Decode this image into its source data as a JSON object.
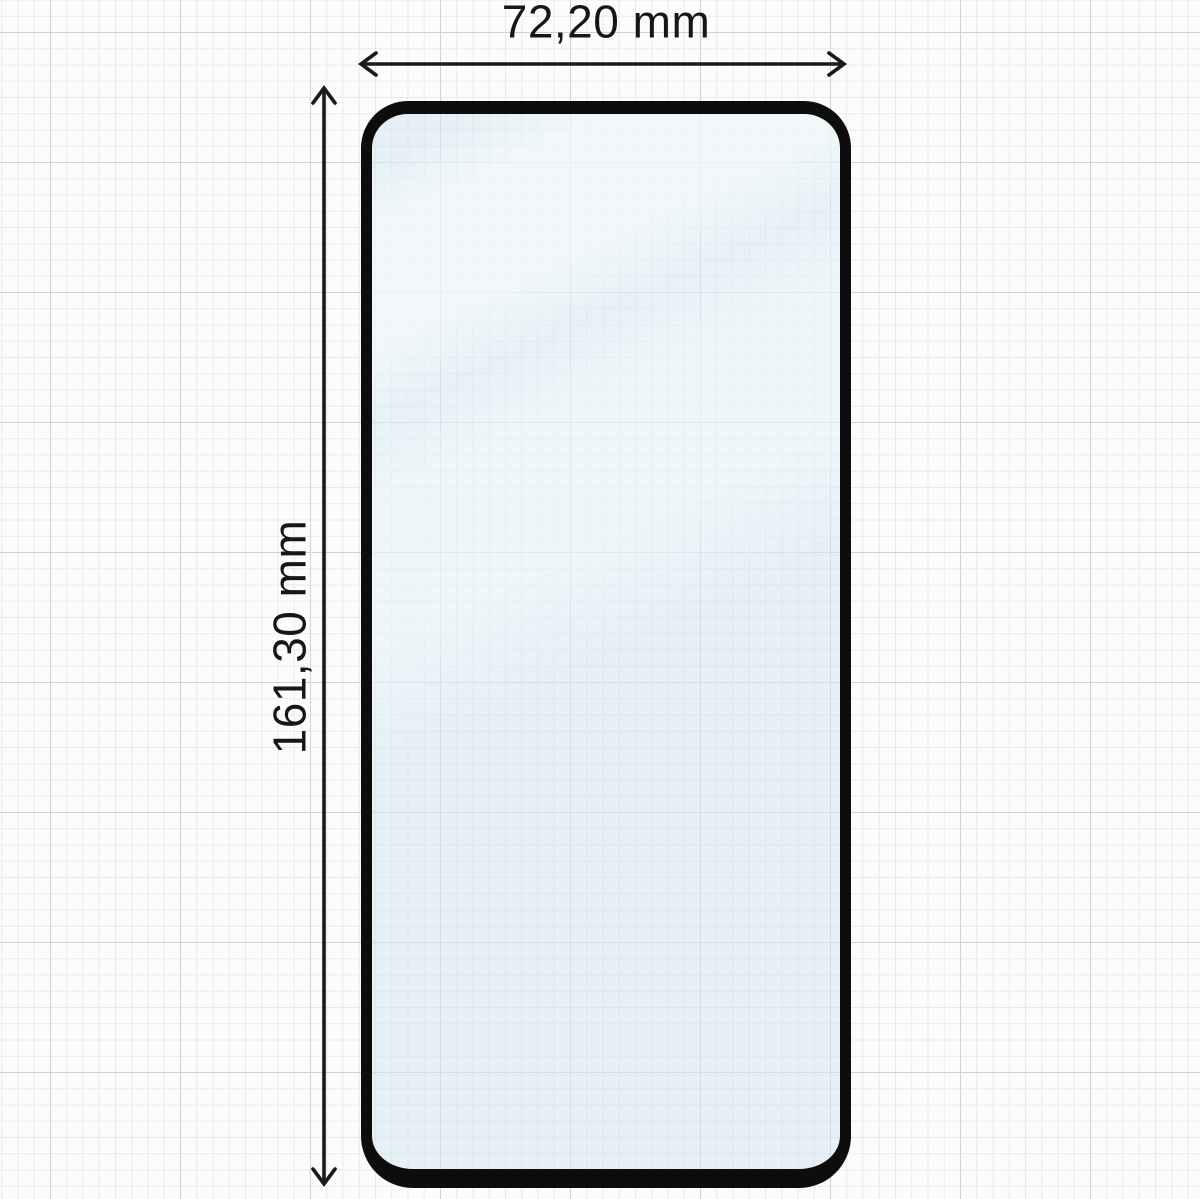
{
  "diagram": {
    "width_dimension": "72,20 mm",
    "height_dimension": "161,30 mm"
  },
  "colors": {
    "paper": "#fcfcfc",
    "grid_minor": "#ebe9e8",
    "grid_major": "#d2d2d2",
    "glass_border": "#0d0d0d",
    "glass_tint": "rgba(209, 231, 240, 0.55)",
    "arrow": "#1a1a1a",
    "label": "#161616"
  }
}
